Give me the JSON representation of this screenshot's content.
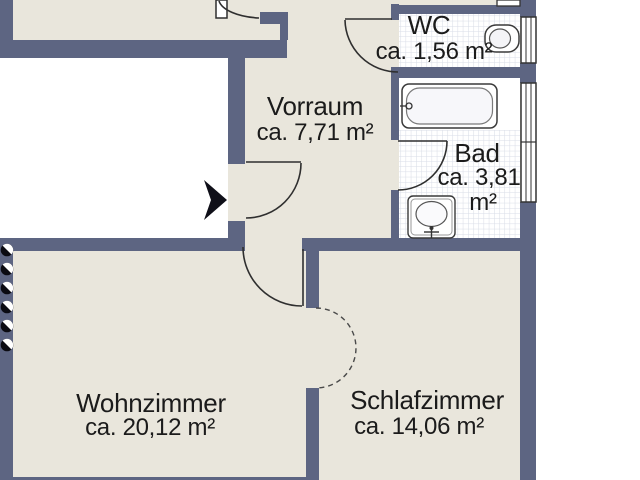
{
  "plan_type": "apartment-floor-plan",
  "rooms": {
    "vorraum": {
      "name": "Vorraum",
      "area": "ca. 7,71 m²"
    },
    "wc": {
      "name": "WC",
      "area": "ca. 1,56 m²"
    },
    "bad": {
      "name": "Bad",
      "area_line1": "ca. 3,81",
      "area_line2": "m²"
    },
    "wohnzimmer": {
      "name": "Wohnzimmer",
      "area": "ca. 20,12 m²"
    },
    "schlafzimmer": {
      "name": "Schlafzimmer",
      "area": "ca. 14,06 m²"
    }
  },
  "colors": {
    "wall": "#5d6582",
    "floor": "#e9e6dc",
    "tile_floor": "#ffffff",
    "tile_line": "#d8dce6",
    "outline": "#2f2f2f",
    "exterior": "#ffffff",
    "text": "#1b1b1b"
  },
  "symbols": [
    "entrance-arrow",
    "door-swing",
    "dashed-opening-arc",
    "window",
    "radiator",
    "bathtub",
    "toilet",
    "sink"
  ]
}
